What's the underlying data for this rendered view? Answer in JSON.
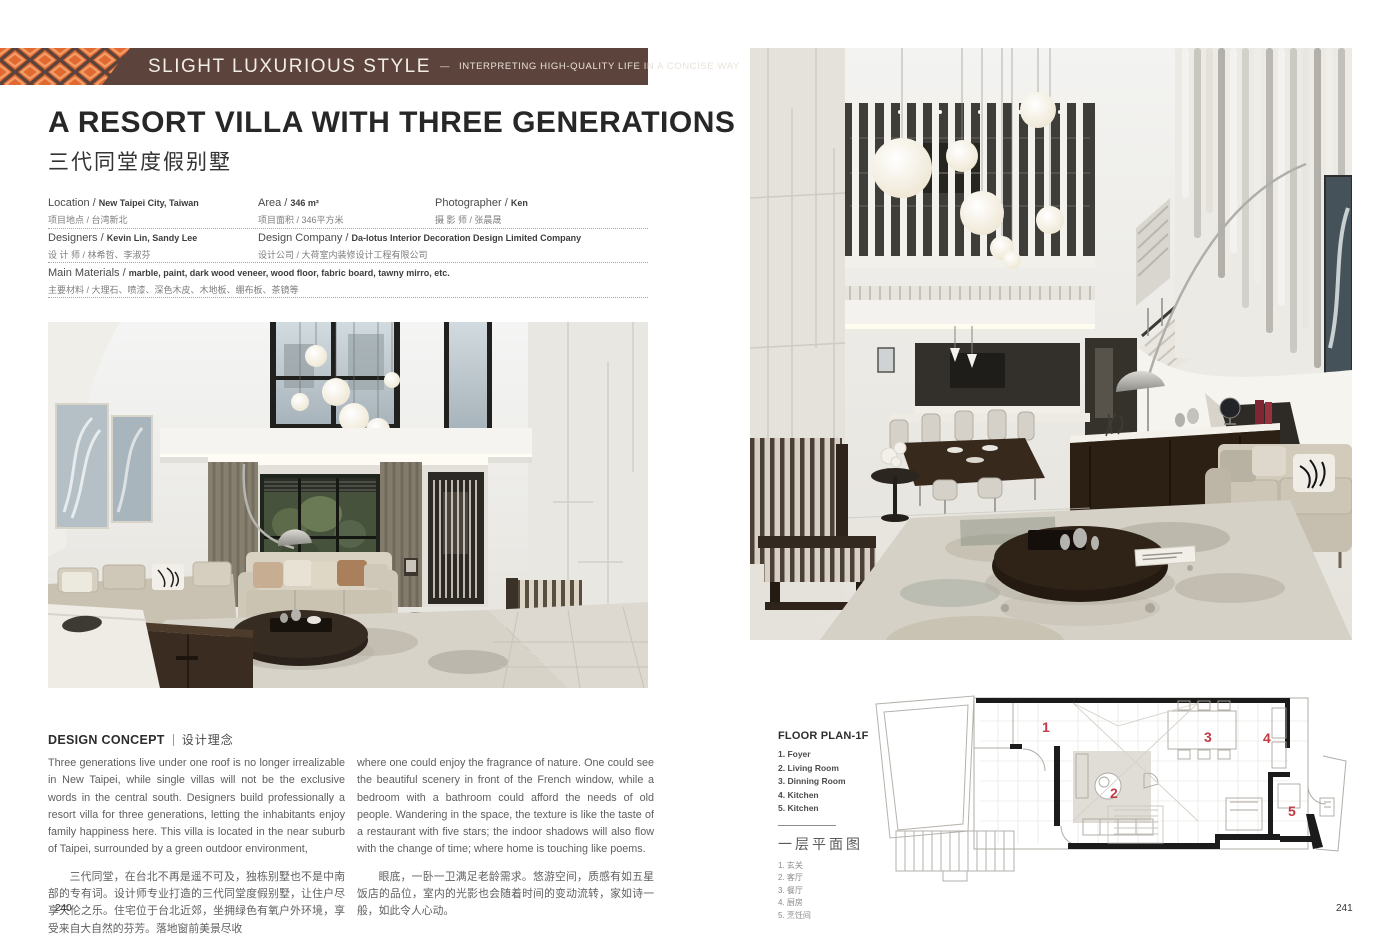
{
  "pages": {
    "left_number": "240",
    "right_number": "241"
  },
  "banner": {
    "title": "SLIGHT LUXURIOUS STYLE",
    "separator": "—",
    "subtitle": "INTERPRETING HIGH-QUALITY LIFE IN A CONCISE WAY",
    "colors": {
      "bar_brown": "#5c433b",
      "pattern_orange": "#e06a32",
      "pattern_light_orange": "#f39e68"
    }
  },
  "project": {
    "title_en": "A RESORT VILLA WITH THREE GENERATIONS",
    "title_zh": "三代同堂度假别墅"
  },
  "info": {
    "location": {
      "label": "Location / ",
      "value": "New Taipei City, Taiwan",
      "zh": "项目地点 / 台湾新北"
    },
    "area": {
      "label": "Area / ",
      "value": "346 m²",
      "zh": "项目面积 / 346平方米"
    },
    "photographer": {
      "label": "Photographer / ",
      "value": "Ken",
      "zh": "摄 影 师 / 张晨晟"
    },
    "designers": {
      "label": "Designers / ",
      "value": "Kevin Lin, Sandy Lee",
      "zh": "设 计 师 / 林希哲、李淑芬"
    },
    "company": {
      "label": "Design Company / ",
      "value": "Da-lotus Interior Decoration Design Limited Company",
      "zh": "设计公司 / 大荷室内装修设计工程有限公司"
    },
    "materials": {
      "label": "Main Materials / ",
      "value": "marble, paint, dark wood veneer, wood floor, fabric board, tawny mirro, etc.",
      "zh": "主要材料 / 大理石、喷漆、深色木皮、木地板、绷布板、茶镜等"
    }
  },
  "concept": {
    "heading_en": "DESIGN CONCEPT",
    "heading_zh": "设计理念",
    "col1_en": "Three generations live under one roof is no longer irrealizable in New Taipei, while single villas will not be the exclusive words in the central south. Designers build professionally a resort villa for three generations, letting the inhabitants enjoy family happiness here. This villa is located in the near suburb of Taipei, surrounded by a green outdoor environment,",
    "col1_zh": "三代同堂，在台北不再是遥不可及，独栋别墅也不是中南部的专有词。设计师专业打造的三代同堂度假别墅，让住户尽享天伦之乐。住宅位于台北近郊，坐拥绿色有氧户外环境，享受来自大自然的芬芳。落地窗前美景尽收",
    "col2_en": "where one could enjoy the fragrance of nature. One could see the beautiful scenery in front of the French window, while a bedroom with a bathroom could afford the needs of old people. Wandering in the space, the texture is like the taste of a restaurant with five stars; the indoor shadows will also flow with the change of time; where home is touching like poems.",
    "col2_zh": "眼底，一卧一卫满足老龄需求。悠游空间，质感有如五星饭店的品位，室内的光影也会随着时间的变动流转，家如诗一般，如此令人心动。"
  },
  "floorplan": {
    "title": "FLOOR PLAN-1F",
    "items_en": [
      "1. Foyer",
      "2. Living Room",
      "3. Dinning Room",
      "4. Kitchen",
      "5. Kitchen"
    ],
    "title_zh": "一层平面图",
    "items_zh": [
      "1. 玄关",
      "2. 客厅",
      "3. 餐厅",
      "4. 厨房",
      "5. 烹饪间"
    ],
    "markers": [
      "1",
      "2",
      "3",
      "4",
      "5"
    ],
    "marker_color": "#c23a44"
  }
}
